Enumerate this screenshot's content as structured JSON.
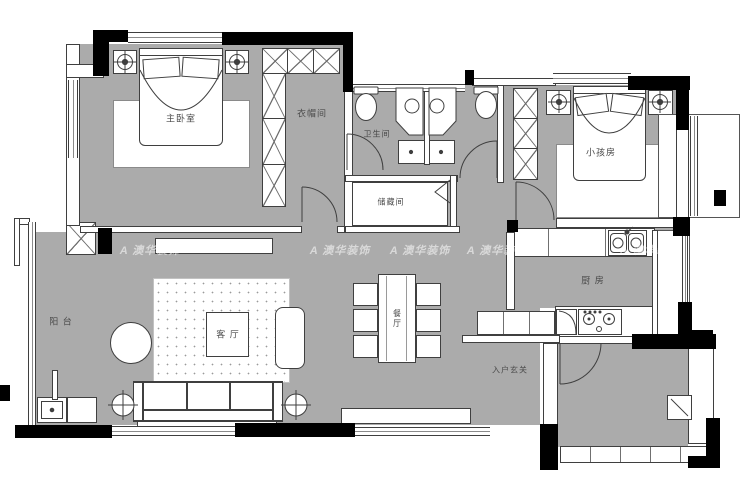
{
  "floorplan": {
    "rooms": {
      "master_bedroom": "主卧室",
      "cloakroom": "衣帽间",
      "bathroom": "卫生间",
      "storage_room": "储藏间",
      "kids_room": "小孩房",
      "kitchen": "厨 房",
      "dining_room": "餐厅",
      "living_room": "客 厅",
      "balcony": "阳 台",
      "entry_foyer": "入户玄关"
    },
    "watermark": {
      "logo": "A",
      "text": "澳华装饰"
    },
    "colors": {
      "floor": "#ababab",
      "wall": "#000000",
      "line": "#3f3f3f"
    }
  }
}
